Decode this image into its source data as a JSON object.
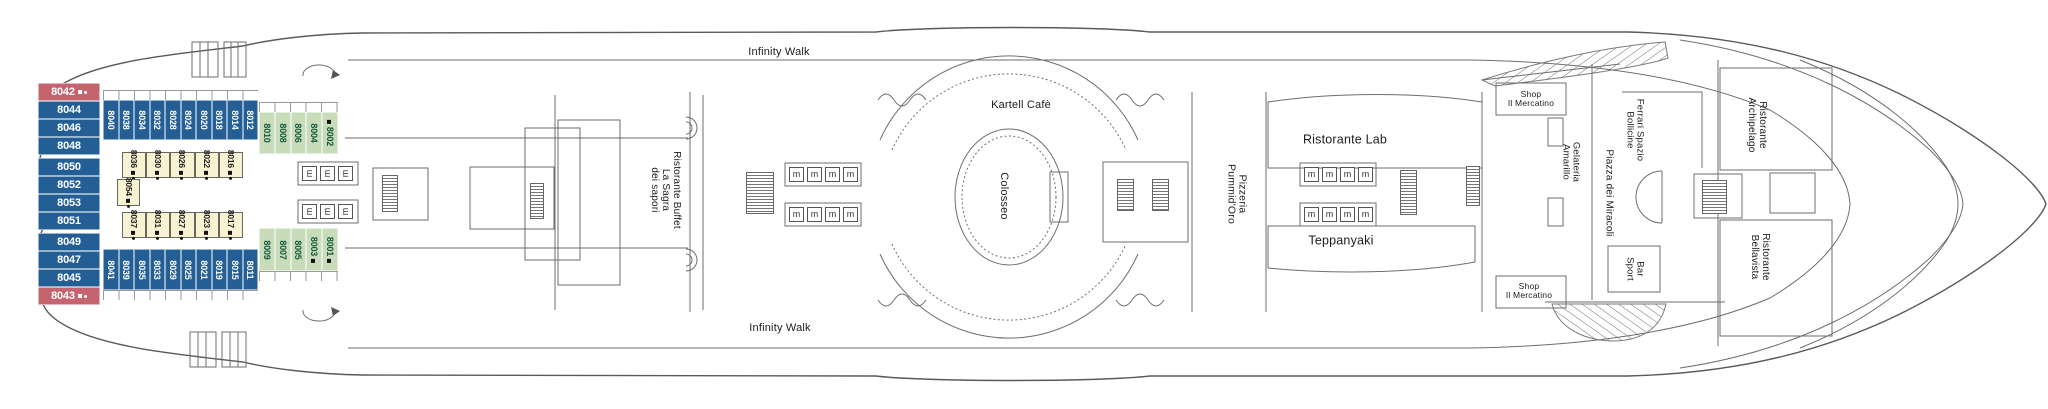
{
  "deck_plan": {
    "venues": {
      "infinity_walk": "Infinity Walk",
      "kartell_cafe": "Kartell Cafè",
      "colosseo": "Colosseo",
      "pizzeria": [
        "Pizzeria",
        "Pummid'Oro"
      ],
      "ristorante_lab": "Ristorante Lab",
      "teppanyaki": "Teppanyaki",
      "shop_mercatino": [
        "Shop",
        "Il Mercatino"
      ],
      "gelateria": [
        "Gelateria",
        "Amarillo"
      ],
      "ferrari": [
        "Ferrari Spazio",
        "Bollicine"
      ],
      "piazza": "Piazza dei Miracoli",
      "bar_sport": [
        "Bar",
        "Sport"
      ],
      "archipelago": [
        "Ristorante",
        "Archipelago"
      ],
      "bellavista": [
        "Ristorante",
        "Bellavista"
      ],
      "buffet": [
        "Ristorante Buffet",
        "La Sagra",
        "dei sapori"
      ]
    },
    "colors": {
      "balcony_blue": "#235e95",
      "suite_red": "#c5636f",
      "oceanview_green": "#c9dcba",
      "inside_yellow": "#f7f2d2",
      "green_text": "#14583f",
      "line_gray": "#6e6e6e"
    },
    "elevator_glyph": "m",
    "cabin_rows": [
      {
        "id": "aft-stack",
        "orient": "h",
        "x": 38,
        "y": 83,
        "cell_w": 62,
        "cell_h": 18,
        "gap_after": [
          3,
          7
        ],
        "cabins": [
          {
            "n": "8042",
            "c": "red",
            "m": "sd"
          },
          {
            "n": "8044",
            "c": "blue"
          },
          {
            "n": "8046",
            "c": "blue"
          },
          {
            "n": "8048",
            "c": "blue"
          },
          {
            "n": "8050",
            "c": "blue"
          },
          {
            "n": "8052",
            "c": "blue"
          },
          {
            "n": "8053",
            "c": "blue"
          },
          {
            "n": "8051",
            "c": "blue"
          },
          {
            "n": "8049",
            "c": "blue"
          },
          {
            "n": "8047",
            "c": "blue"
          },
          {
            "n": "8045",
            "c": "blue"
          },
          {
            "n": "8043",
            "c": "red",
            "m": "sd"
          }
        ]
      },
      {
        "id": "top-balcony",
        "orient": "v",
        "x": 103,
        "y": 100,
        "cell_w": 15.5,
        "cell_h": 40,
        "cabins": [
          {
            "n": "8040",
            "c": "blue"
          },
          {
            "n": "8038",
            "c": "blue"
          },
          {
            "n": "8034",
            "c": "blue"
          },
          {
            "n": "8032",
            "c": "blue"
          },
          {
            "n": "8028",
            "c": "blue"
          },
          {
            "n": "8024",
            "c": "blue"
          },
          {
            "n": "8020",
            "c": "blue"
          },
          {
            "n": "8018",
            "c": "blue"
          },
          {
            "n": "8014",
            "c": "blue"
          },
          {
            "n": "8012",
            "c": "blue"
          }
        ]
      },
      {
        "id": "top-oceanview",
        "orient": "v",
        "x": 259,
        "y": 112,
        "cell_w": 15.8,
        "cell_h": 42,
        "cabins": [
          {
            "n": "8010",
            "c": "green"
          },
          {
            "n": "8008",
            "c": "green"
          },
          {
            "n": "8006",
            "c": "green"
          },
          {
            "n": "8004",
            "c": "green"
          },
          {
            "n": "8002",
            "c": "green",
            "m": "s",
            "mpos": "pre"
          }
        ]
      },
      {
        "id": "top-inside",
        "orient": "v",
        "x": 122,
        "y": 152,
        "cell_w": 24.2,
        "cell_h": 26,
        "cabins": [
          {
            "n": "8036",
            "c": "yellow",
            "m": "sd"
          },
          {
            "n": "8030",
            "c": "yellow",
            "m": "sd"
          },
          {
            "n": "8026",
            "c": "yellow",
            "m": "sd"
          },
          {
            "n": "8022",
            "c": "yellow",
            "m": "sd"
          },
          {
            "n": "8016",
            "c": "yellow",
            "m": "sd"
          }
        ]
      },
      {
        "id": "mid-inside",
        "orient": "v",
        "x": 117,
        "y": 179,
        "cell_w": 23,
        "cell_h": 27,
        "cabins": [
          {
            "n": "8054",
            "c": "yellow",
            "m": "sd"
          }
        ]
      },
      {
        "id": "bottom-inside",
        "orient": "v",
        "x": 122,
        "y": 212,
        "cell_w": 24.2,
        "cell_h": 26,
        "cabins": [
          {
            "n": "8037",
            "c": "yellow",
            "m": "sd"
          },
          {
            "n": "8031",
            "c": "yellow",
            "m": "sd"
          },
          {
            "n": "8027",
            "c": "yellow",
            "m": "sd"
          },
          {
            "n": "8023",
            "c": "yellow",
            "m": "sd"
          },
          {
            "n": "8017",
            "c": "yellow",
            "m": "sd"
          }
        ]
      },
      {
        "id": "bottom-balcony",
        "orient": "v",
        "x": 103,
        "y": 249,
        "cell_w": 15.5,
        "cell_h": 41,
        "cabins": [
          {
            "n": "8041",
            "c": "blue"
          },
          {
            "n": "8039",
            "c": "blue"
          },
          {
            "n": "8035",
            "c": "blue"
          },
          {
            "n": "8033",
            "c": "blue"
          },
          {
            "n": "8029",
            "c": "blue"
          },
          {
            "n": "8025",
            "c": "blue"
          },
          {
            "n": "8021",
            "c": "blue"
          },
          {
            "n": "8019",
            "c": "blue"
          },
          {
            "n": "8015",
            "c": "blue"
          },
          {
            "n": "8011",
            "c": "blue"
          }
        ]
      },
      {
        "id": "bottom-oceanview",
        "orient": "v",
        "x": 259,
        "y": 228,
        "cell_w": 15.8,
        "cell_h": 43,
        "cabins": [
          {
            "n": "8009",
            "c": "green"
          },
          {
            "n": "8007",
            "c": "green"
          },
          {
            "n": "8005",
            "c": "green"
          },
          {
            "n": "8003",
            "c": "green",
            "m": "s"
          },
          {
            "n": "8001",
            "c": "green",
            "m": "s"
          }
        ]
      }
    ],
    "elevator_banks": [
      {
        "x": 302,
        "y": 166,
        "count": 3,
        "spacing": 18,
        "rot": true
      },
      {
        "x": 302,
        "y": 204,
        "count": 3,
        "spacing": 18,
        "rot": true
      },
      {
        "x": 789,
        "y": 167,
        "count": 4,
        "spacing": 18
      },
      {
        "x": 789,
        "y": 207,
        "count": 4,
        "spacing": 18
      },
      {
        "x": 1304,
        "y": 167,
        "count": 4,
        "spacing": 18
      },
      {
        "x": 1304,
        "y": 207,
        "count": 4,
        "spacing": 18
      }
    ],
    "stairs": [
      [
        382,
        175,
        16,
        37
      ],
      [
        530,
        183,
        14,
        36
      ],
      [
        746,
        172,
        28,
        42
      ],
      [
        1117,
        179,
        17,
        32
      ],
      [
        1152,
        179,
        17,
        32
      ],
      [
        1400,
        170,
        17,
        45
      ],
      [
        1466,
        166,
        14,
        40
      ],
      [
        1702,
        180,
        25,
        34
      ]
    ]
  }
}
